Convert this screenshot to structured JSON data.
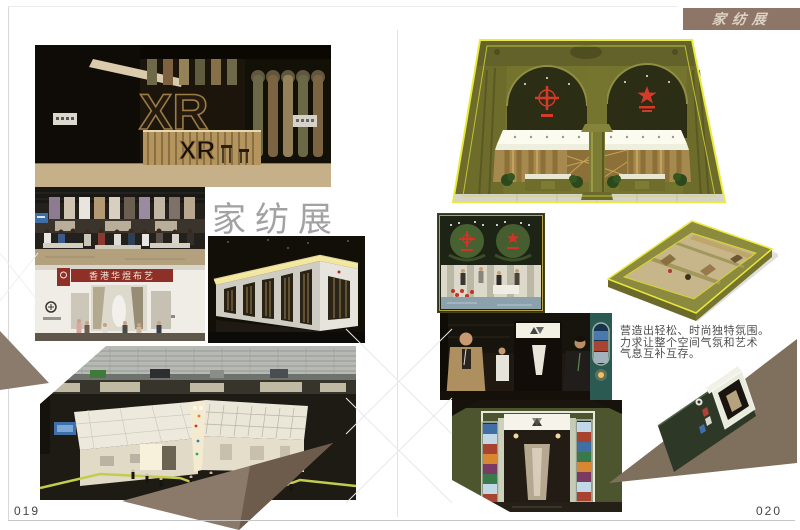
{
  "banner": {
    "title": "家纺展",
    "bg": "#8d7568",
    "fg": "#dcd1c0"
  },
  "heading": {
    "text": "家纺展",
    "color": "#a2a2a2"
  },
  "pages": {
    "left_number": "019",
    "right_number": "020"
  },
  "description": {
    "lines": [
      "营造出轻松、时尚独特氛围。",
      "力求让整个空间气氛和艺术",
      "气息互补互存。"
    ],
    "color": "#4d4d4d"
  },
  "photo_labels": {
    "xr_large": "XR",
    "xr_desk": "XR",
    "hk_sign": "香港华煜布艺"
  },
  "colors": {
    "banner_bg": "#8d7568",
    "olive_wall": "#75742f",
    "trim_yellow": "#eaea3e",
    "emblem_red": "#d23b2a",
    "taupe_triangle": "#7f6f5d",
    "dark_card_green": "#2d3926",
    "tape_line_green": "#c3cd4c",
    "hk_sign_red": "#8e2f28"
  }
}
